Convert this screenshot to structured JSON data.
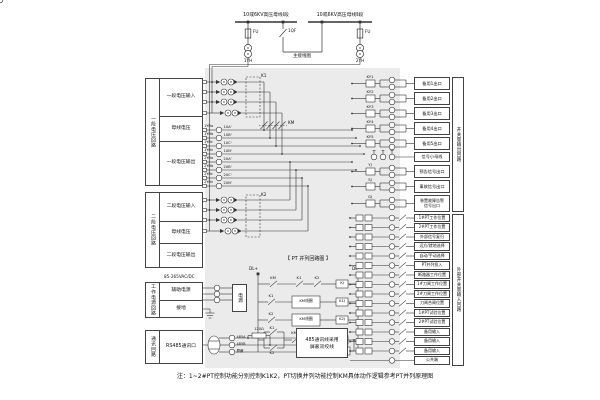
{
  "note": "注：1~2#PT控制功能分别控制K1K2，PT切换并列功能控制KM具体动作逻辑参考PT并列原理图",
  "top": {
    "bus1": "10或6KV高压母线Ⅰ段",
    "bus2": "10或6KV高压母线Ⅱ段",
    "fu1": "FU",
    "fu2": "FU",
    "qf": "1QF",
    "pt1": "1YH",
    "pt2": "2YH",
    "main_wiring": "主接线图"
  },
  "left": {
    "s1": {
      "v": "一段电压回路",
      "r1": "一段电压输入",
      "r2": "母线电压",
      "r3": "一段电压输出"
    },
    "s2": {
      "v": "二段电压回路",
      "r1": "二段电压输入",
      "r2": "母线电压",
      "r3": "二段电压输出"
    },
    "s3": {
      "v": "工作电源回路",
      "r1": "辅助电源",
      "r2": "接地"
    },
    "s4": {
      "v": "通讯回路",
      "r1": "RS485通讯口"
    }
  },
  "mid": {
    "k1": "K1",
    "k2": "K2",
    "km": "KM",
    "t1": [
      {
        "w": "1YHa",
        "t": "1UA'"
      },
      {
        "w": "1YHb",
        "t": "1UB'"
      },
      {
        "w": "1YHc",
        "t": "1UC'"
      },
      {
        "w": "1YHn",
        "t": "1UN'"
      }
    ],
    "t2": [
      {
        "w": "2YHa",
        "t": "2UA'"
      },
      {
        "w": "2YHb",
        "t": "2UB'"
      },
      {
        "w": "2YHc",
        "t": "2UC'"
      },
      {
        "w": "2YHn",
        "t": "2UN'"
      }
    ],
    "ladder": {
      "title": "【 PT 并列回路图 】",
      "dlp": "DL+",
      "dlm": "DL-",
      "r1c1": "KM",
      "r1c2": "K1",
      "r1c3": "K2",
      "r1coil": "KJ",
      "r2c1": "K1",
      "r2block": "KM线圈",
      "r2coil": "K1J",
      "r3c1": "K2",
      "r3block": "KM线圈",
      "r3coil": "K2J",
      "r4c1": "K1",
      "r4c2": "K2",
      "r4c3": "KM",
      "r4coil": "KM",
      "r4branch": "手动"
    },
    "power": {
      "ac": "85-265VAC/DC",
      "box": "电源"
    },
    "comm": {
      "a": "485A",
      "b": "485B",
      "s": "屏蔽",
      "res": "120Ω",
      "note1": "485通讯线采用",
      "note2": "屏蔽双绞线"
    }
  },
  "right": {
    "out_v": "开关量输出回路",
    "outs": [
      "备用1出口",
      "备用2出口",
      "备用3出口",
      "备用4出口",
      "备用5出口",
      "信号小母线",
      "预告信号出口",
      "事故信号出口"
    ],
    "fault1": "装置故障告警",
    "fault2": "信号出口",
    "contacts": [
      "KY1",
      "KY2",
      "KY3",
      "KY4",
      "KY5",
      "YJ",
      "SJ",
      "GJ"
    ],
    "in_v": "外部开关量输入回路",
    "ins": [
      "1#PT工作位置",
      "2#PT工作位置",
      "外部信号复归",
      "远方/就地选择",
      "自动/手动选择",
      "PT并列投入",
      "断路器工作位置",
      "1#刀闸工作位置",
      "2#刀闸工作位置",
      "刀闸合闸位置",
      "1#PT试验位置",
      "2#PT试验位置",
      "备用输入",
      "备用输入",
      "备用输入",
      "公共端"
    ]
  }
}
